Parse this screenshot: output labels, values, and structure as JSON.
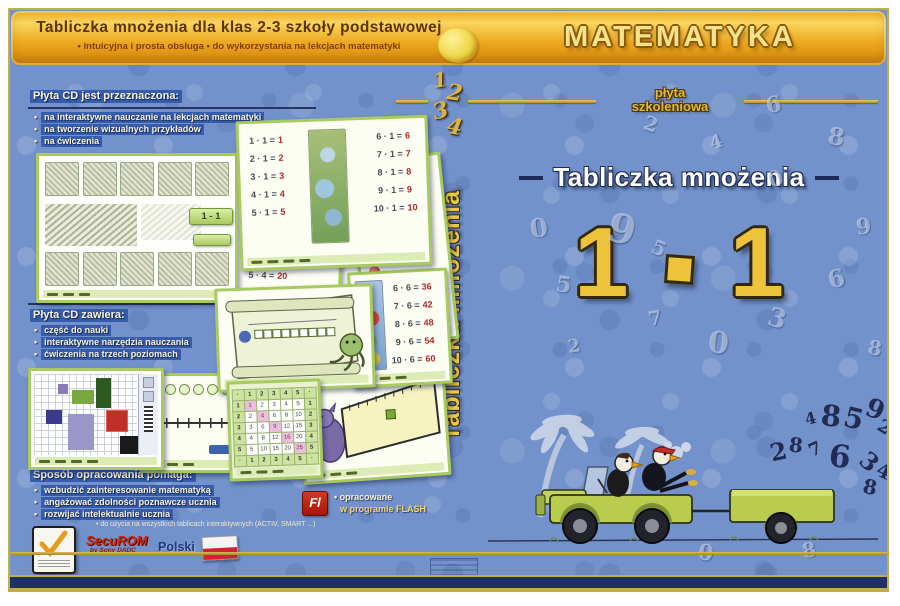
{
  "header": {
    "title": "Tabliczka mnożenia dla klas 2-3 szkoły podstawowej",
    "subtitle": "• intuicyjna i prosta obsługa • do wykorzystania na lekcjach matematyki",
    "brand": "MATEMATYKA"
  },
  "back_cover": {
    "sections": [
      {
        "heading": "Płyta CD jest przeznaczona:",
        "bullets": [
          "na interaktywne nauczanie na lekcjach matematyki",
          "na tworzenie wizualnych przykładów",
          "na ćwiczenia"
        ]
      },
      {
        "heading": "Płyta CD zawiera:",
        "bullets": [
          "część do nauki",
          "interaktywne narzędzia nauczania",
          "ćwiczenia na trzech poziomach"
        ]
      },
      {
        "heading": "Sposób opracowania pomaga:",
        "bullets": [
          "wzbudzić zainteresowanie matematyką",
          "angażować zdolności poznawcze ucznia",
          "rozwijać intelektualnie ucznia"
        ]
      }
    ],
    "footnote": "• do użycia na wszystkich tablicach interaktywnych (ACTIV, SMART ...)",
    "flash": {
      "badge": "Fl",
      "line1": "• opracowane",
      "line2": "w programie FLASH"
    },
    "securom": {
      "name": "SecuROM",
      "sub": "by Sony DADC"
    },
    "language": "Polski"
  },
  "spine": {
    "deco_numbers": [
      "1",
      "2",
      "3",
      "4"
    ],
    "title": "Tabliczka mnożenia"
  },
  "front_cover": {
    "disc_label_line1": "płyta",
    "disc_label_line2": "szkoleniowa",
    "title": "Tabliczka mnożenia",
    "expression": "1 · 1",
    "digit_a": "1",
    "digit_b": "1",
    "flying_numbers": [
      "4",
      "8",
      "5",
      "9",
      "2",
      "2",
      "8",
      "7",
      "6",
      "3",
      "4",
      "8"
    ],
    "ghost_numbers": [
      "9",
      "6",
      "2",
      "0",
      "8",
      "4",
      "5",
      "7",
      "3",
      "9",
      "0",
      "6",
      "8",
      "2",
      "5",
      "0",
      "0",
      "8"
    ]
  },
  "screenshots": {
    "times1": {
      "lhs_left": [
        "1 · 1 =",
        "2 · 1 =",
        "3 · 1 =",
        "4 · 1 =",
        "5 · 1 ="
      ],
      "res_left": [
        "1",
        "2",
        "3",
        "4",
        "5"
      ],
      "lhs_right": [
        "6 · 1 =",
        "7 · 1 =",
        "8 · 1 =",
        "9 · 1 =",
        "10 · 1 ="
      ],
      "res_right": [
        "6",
        "7",
        "8",
        "9",
        "10"
      ]
    },
    "times3": {
      "lhs": [
        "6 · 3 =",
        "7 · 3 =",
        "8 · 3 =",
        "9 · 3 =",
        "10 · 3 ="
      ],
      "res": [
        "18",
        "21",
        "24",
        "27",
        "30"
      ]
    },
    "times4": {
      "lhs": [
        "2 · 4 =",
        "3 · 4 =",
        "4 · 4 =",
        "5 · 4 ="
      ],
      "res": [
        "8",
        "12",
        "16",
        "20"
      ]
    },
    "arrow_card": {
      "eq1_lhs": "5 · 3 =",
      "eq1_res": "15",
      "eq2_lhs": "10 · 4 =",
      "eq2_res": "40"
    },
    "times6": {
      "lhs": [
        "6 · 6 =",
        "7 · 6 =",
        "8 · 6 =",
        "9 · 6 =",
        "10 · 6 ="
      ],
      "res": [
        "36",
        "42",
        "48",
        "54",
        "60"
      ]
    },
    "times6b": {
      "lhs": [
        "1 · 6 =",
        "2 · 6 ="
      ],
      "res": [
        "6",
        "12"
      ]
    },
    "picture_card": {
      "label": "1 - 1"
    },
    "pythagoras": {
      "grid": [
        [
          "·",
          "1",
          "2",
          "3",
          "4",
          "5",
          "·"
        ],
        [
          "1",
          "1",
          "2",
          "3",
          "4",
          "5",
          "1"
        ],
        [
          "2",
          "2",
          "4",
          "6",
          "8",
          "10",
          "2"
        ],
        [
          "3",
          "3",
          "6",
          "9",
          "12",
          "15",
          "3"
        ],
        [
          "4",
          "4",
          "8",
          "12",
          "16",
          "20",
          "4"
        ],
        [
          "5",
          "5",
          "10",
          "15",
          "20",
          "25",
          "5"
        ],
        [
          "·",
          "1",
          "2",
          "3",
          "4",
          "5",
          "·"
        ]
      ]
    }
  }
}
